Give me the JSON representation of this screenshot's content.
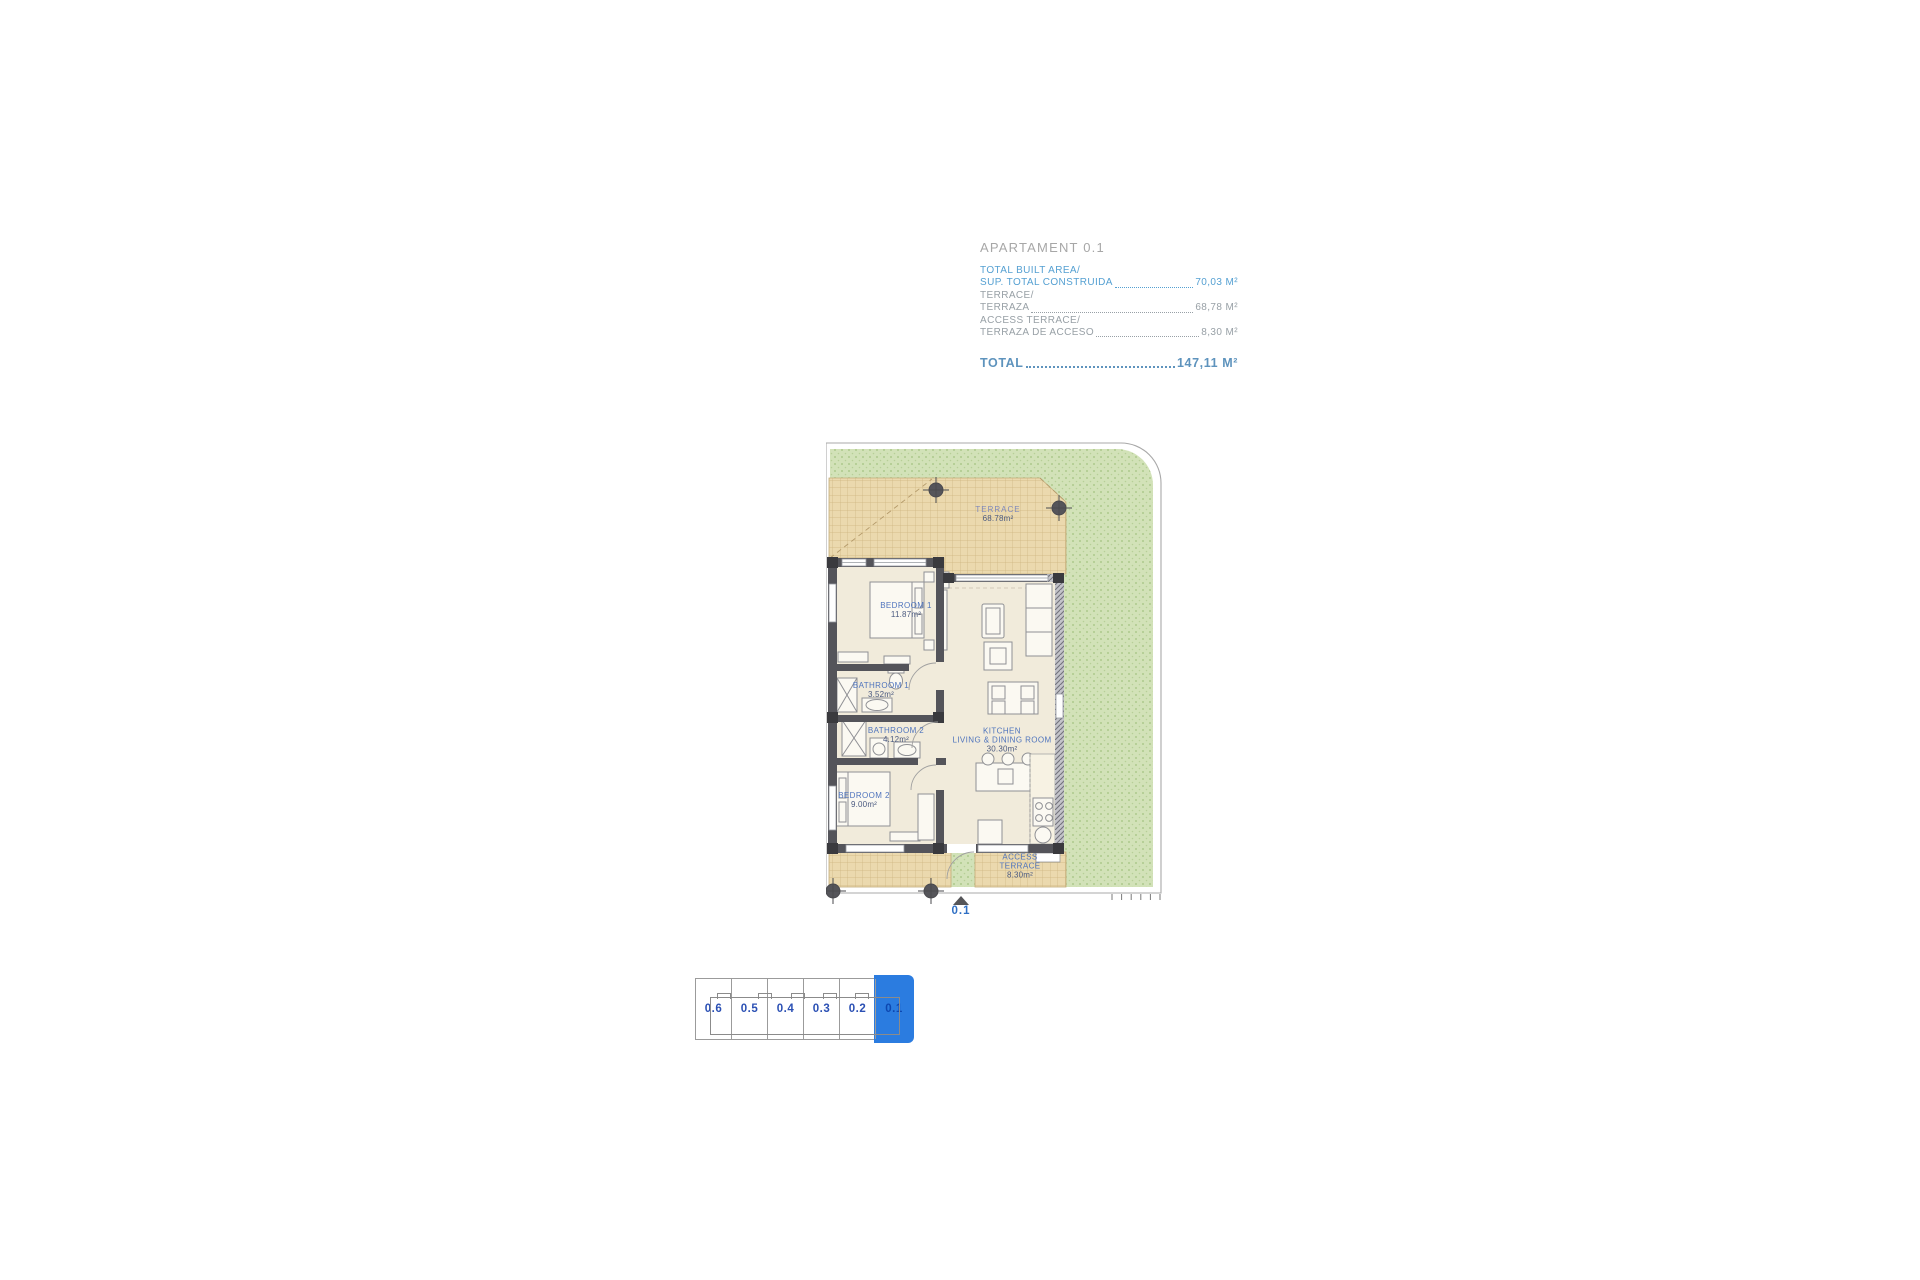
{
  "header": {
    "title": "APARTAMENT 0.1",
    "items": [
      {
        "line1": "TOTAL BUILT AREA/",
        "line2": "SUP. TOTAL CONSTRUIDA",
        "value": "70,03 M²",
        "style": "blue"
      },
      {
        "line1": "TERRACE/",
        "line2": "TERRAZA",
        "value": "68,78 M²",
        "style": "gray"
      },
      {
        "line1": "ACCESS TERRACE/",
        "line2": "TERRAZA DE ACCESO",
        "value": "8,30 M²",
        "style": "gray"
      }
    ],
    "total_label": "TOTAL",
    "total_value": "147,11 M²"
  },
  "plan": {
    "labels": {
      "terrace": {
        "name": "TERRACE",
        "area": "68.78m²"
      },
      "bedroom1": {
        "name": "BEDROOM 1",
        "area": "11.87m²"
      },
      "bathroom1": {
        "name": "BATHROOM 1",
        "area": "3.52m²"
      },
      "bathroom2": {
        "name": "BATHROOM 2",
        "area": "4.12m²"
      },
      "kitchen": {
        "name1": "KITCHEN",
        "name2": "LIVING & DINING ROOM",
        "area": "30.30m²"
      },
      "bedroom2": {
        "name": "BEDROOM 2",
        "area": "9.00m²"
      },
      "access_terrace": {
        "name1": "ACCESS",
        "name2": "TERRACE",
        "area": "8.30m²"
      },
      "unit_marker": "0.1"
    }
  },
  "index": {
    "units": [
      {
        "label": "0.6",
        "selected": false
      },
      {
        "label": "0.5",
        "selected": false
      },
      {
        "label": "0.4",
        "selected": false
      },
      {
        "label": "0.3",
        "selected": false
      },
      {
        "label": "0.2",
        "selected": false
      },
      {
        "label": "0.1",
        "selected": true
      }
    ]
  },
  "colors": {
    "accent_blue": "#2b7ce0",
    "header_blue": "#55a0d2",
    "header_gray": "#98a0a6",
    "total_blue": "#5e93bd",
    "lawn_green": "#d2e2b8",
    "terrace_tan": "#ebd9ae",
    "wall_gray": "#54545a",
    "floor_cream": "#f1ebdb",
    "plan_label_blue": "#4f74bd",
    "index_label_blue": "#2b50b4"
  }
}
